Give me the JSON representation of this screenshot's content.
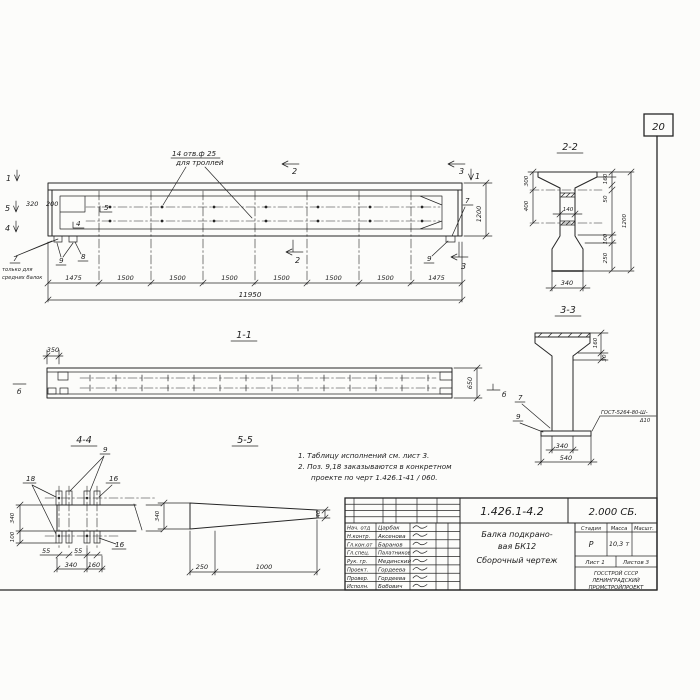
{
  "sheet": {
    "page_number": "20",
    "notes": {
      "line1": "1. Таблицу исполнений см. лист 3.",
      "line2": "2. Поз. 9,18 заказываются в конкретном",
      "line3": "проекте по черт 1.426.1-41 / 060."
    }
  },
  "elevation": {
    "callout_line1": "14 отв.ф 25",
    "callout_line2": "для троллей",
    "left_note_line1": "только для",
    "left_note_line2": "средних балок",
    "dim_320": "320",
    "dim_200": "200",
    "dim_1200": "1200",
    "dim_total": "11950",
    "dim_chain": [
      "1475",
      "1500",
      "1500",
      "1500",
      "1500",
      "1500",
      "1500",
      "1475"
    ],
    "sec_1_left": "1",
    "sec_5_left": "5",
    "sec_4_left": "4",
    "sec_2_top": "2",
    "sec_3_top": "3",
    "sec_1_right": "1",
    "sec_2_bottom": "2",
    "sec_3_bottom": "3",
    "pos_5": "5",
    "pos_4": "4",
    "pos_7_left": "7",
    "pos_8": "8",
    "pos_9_left": "9",
    "pos_9_right": "9",
    "pos_7_right": "7"
  },
  "section_2_2": {
    "title": "2-2",
    "dim_300": "300",
    "dim_400": "400",
    "dim_140": "140",
    "dim_160": "160",
    "dim_50": "50",
    "dim_100": "100",
    "dim_250": "250",
    "dim_1200": "1200",
    "dim_340": "340"
  },
  "section_3_3": {
    "title": "3-3",
    "dim_160": "160",
    "dim_30": "30",
    "dim_340": "340",
    "dim_540": "540",
    "pos_7": "7",
    "pos_9": "9",
    "weld_line1": "ГОСТ-5264-80-Ш-",
    "weld_line2": "Δ10"
  },
  "section_1_1": {
    "title": "1-1",
    "dim_350": "350",
    "dim_650": "650",
    "marker_b_left": "б",
    "marker_b_right": "б"
  },
  "section_4_4": {
    "title": "4-4",
    "pos_9": "9",
    "pos_18": "18",
    "pos_16_right": "16",
    "pos_16_bottom": "16",
    "dim_340_side": "340",
    "dim_100": "100",
    "dim_55_first": "55",
    "dim_55_second": "55",
    "dim_340_bottom": "340",
    "dim_160": "160"
  },
  "section_5_5": {
    "title": "5-5",
    "dim_340": "340",
    "dim_40": "40",
    "dim_250": "250",
    "dim_1000": "1000"
  },
  "title_block": {
    "doc_number": "1.426.1-4.2",
    "doc_code": "2.000 СБ.",
    "title_line1": "Балка подкрано-",
    "title_line2": "вая БК12",
    "title_line3": "Сборочный чертеж",
    "col_stage": "Стадия",
    "col_mass": "Масса",
    "col_scale": "Масшт.",
    "stage": "Р",
    "mass": "10,3 т",
    "sheet_label": "Лист 1",
    "sheets_label": "Листов 3",
    "org_line1": "ГОССТРОЙ СССР",
    "org_line2": "ЛЕНИНГРАДСКИЙ",
    "org_line3": "ПРОМСТРОЙПРОЕКТ",
    "rows": [
      {
        "role": "Нач. отд",
        "name": "Царбак"
      },
      {
        "role": "Н.контр.",
        "name": "Аксенова"
      },
      {
        "role": "Гл.кон.от",
        "name": "Баранов"
      },
      {
        "role": "Гл.спец.",
        "name": "Палатников"
      },
      {
        "role": "Рук. гр.",
        "name": "Мединский"
      },
      {
        "role": "Проект.",
        "name": "Гордеева"
      },
      {
        "role": "Провер.",
        "name": "Гордеева"
      },
      {
        "role": "Исполн.",
        "name": "Бобович"
      }
    ]
  }
}
